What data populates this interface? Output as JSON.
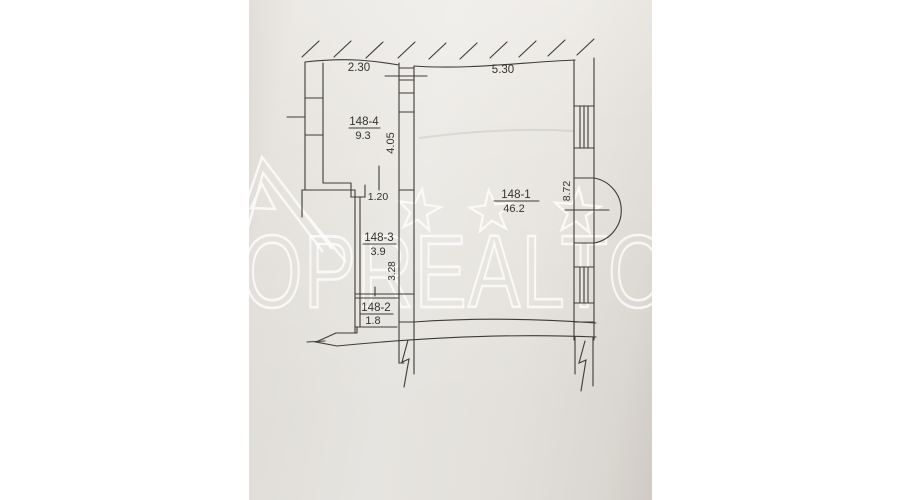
{
  "watermark": {
    "text": "OPREALTO"
  },
  "rooms": [
    {
      "id": "148-4",
      "area": "9.3"
    },
    {
      "id": "148-3",
      "area": "3.9"
    },
    {
      "id": "148-2",
      "area": "1.8"
    },
    {
      "id": "148-1",
      "area": "46.2"
    }
  ],
  "dims": {
    "w_room4": "2.30",
    "w_room1": "5.30",
    "h_room4": "4.05",
    "w_hall": "1.20",
    "h_hall": "3.28",
    "h_room1": "8.72"
  },
  "colors": {
    "paper": "#ebe8e3",
    "line": "#3e3b37",
    "watermark": "#ffffff"
  }
}
